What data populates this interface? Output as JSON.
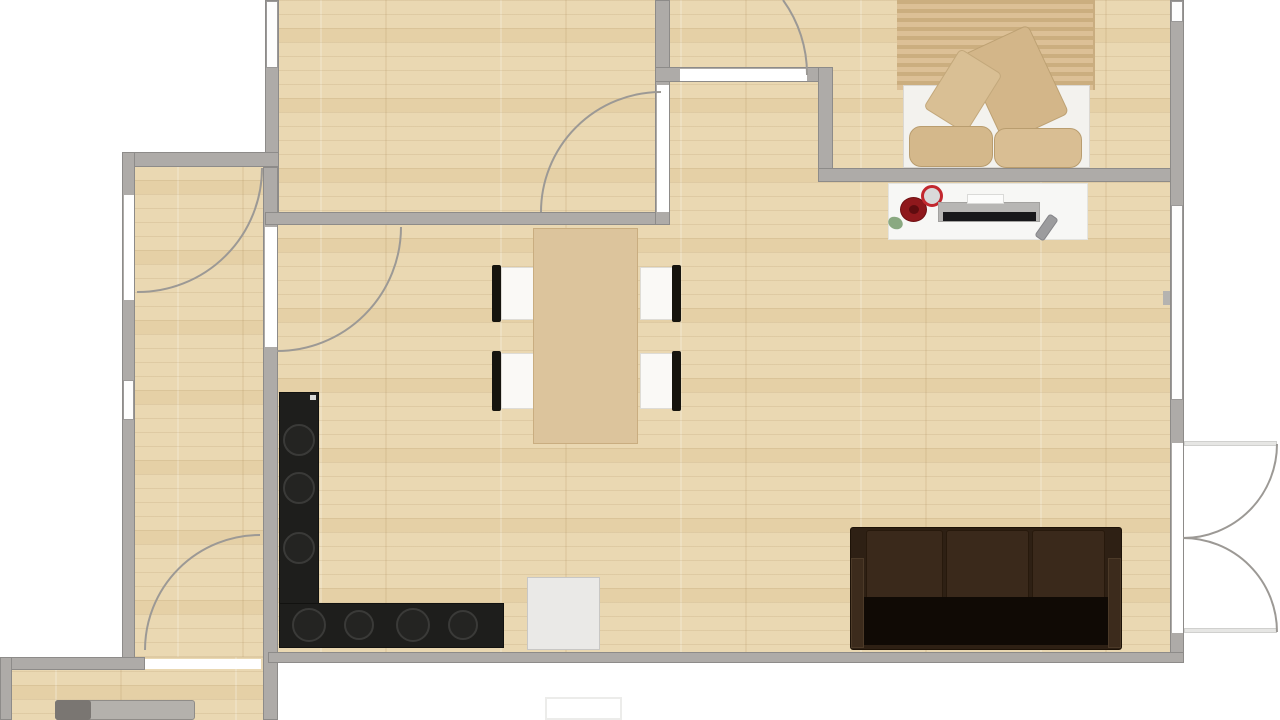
{
  "document": {
    "kind": "apartment-floor-plan",
    "visible_text": ""
  },
  "palette": {
    "background": "#ffffff",
    "wall": "#aeaba8",
    "wall_edge": "#8d8b89",
    "floor_wood": "#ead8b2",
    "opening": "#ffffff",
    "counter_black": "#1e1e1c",
    "sofa_brown": "#2e2014",
    "accent_red": "#c2272e"
  },
  "floors": [
    {
      "n": "floor-main-rooms",
      "cls": "wood",
      "x": 265,
      "y": 0,
      "w": 919,
      "h": 663,
      "z": 1
    },
    {
      "n": "floor-hallway",
      "cls": "wood",
      "x": 122,
      "y": 152,
      "w": 155,
      "h": 511,
      "z": 1
    },
    {
      "n": "floor-bottom-room",
      "cls": "wood",
      "x": 0,
      "y": 657,
      "w": 278,
      "h": 63,
      "z": 1
    },
    {
      "n": "bedroom-rug",
      "cls": "rug",
      "x": 897,
      "y": 0,
      "w": 198,
      "h": 90,
      "z": 2
    }
  ],
  "walls": [
    {
      "n": "wall-room2-left",
      "x": 265,
      "y": 0,
      "w": 14,
      "h": 225
    },
    {
      "n": "wall-hall-top",
      "x": 122,
      "y": 152,
      "w": 157,
      "h": 15
    },
    {
      "n": "wall-hall-left",
      "x": 122,
      "y": 152,
      "w": 13,
      "h": 511
    },
    {
      "n": "wall-divider-vert",
      "x": 263,
      "y": 167,
      "w": 15,
      "h": 553
    },
    {
      "n": "wall-room2-bottom",
      "x": 265,
      "y": 212,
      "w": 405,
      "h": 13
    },
    {
      "n": "wall-room2-right",
      "x": 655,
      "y": 0,
      "w": 15,
      "h": 225
    },
    {
      "n": "wall-bedroom-top",
      "x": 655,
      "y": 67,
      "w": 178,
      "h": 15
    },
    {
      "n": "wall-bedroom-west",
      "x": 818,
      "y": 67,
      "w": 15,
      "h": 115
    },
    {
      "n": "wall-bedroom-bottom",
      "x": 818,
      "y": 168,
      "w": 366,
      "h": 14
    },
    {
      "n": "wall-right",
      "x": 1170,
      "y": 0,
      "w": 14,
      "h": 662
    },
    {
      "n": "wall-bottom-main",
      "x": 268,
      "y": 652,
      "w": 916,
      "h": 11
    },
    {
      "n": "wall-room3-top",
      "x": 0,
      "y": 657,
      "w": 145,
      "h": 13
    },
    {
      "n": "wall-room3-left",
      "x": 0,
      "y": 657,
      "w": 12,
      "h": 63
    }
  ],
  "windows": [
    {
      "n": "window-room2-left",
      "x": 266,
      "y": 1,
      "w": 12,
      "h": 67
    },
    {
      "n": "window-hall-left",
      "x": 123,
      "y": 380,
      "w": 11,
      "h": 40
    },
    {
      "n": "window-right-top",
      "x": 1171,
      "y": 1,
      "w": 12,
      "h": 21
    },
    {
      "n": "window-right-mid",
      "x": 1171,
      "y": 205,
      "w": 12,
      "h": 195
    }
  ],
  "openings": [
    {
      "n": "opening-entry-door",
      "x": 124,
      "y": 195,
      "w": 10,
      "h": 105
    },
    {
      "n": "opening-hall-living",
      "x": 265,
      "y": 227,
      "w": 12,
      "h": 120
    },
    {
      "n": "opening-room2-door",
      "x": 657,
      "y": 85,
      "w": 12,
      "h": 127
    },
    {
      "n": "opening-bedroom-door",
      "x": 680,
      "y": 69,
      "w": 127,
      "h": 12
    },
    {
      "n": "opening-hall-bottom",
      "x": 145,
      "y": 659,
      "w": 116,
      "h": 10
    },
    {
      "n": "opening-balcony-doors",
      "x": 1172,
      "y": 443,
      "w": 11,
      "h": 190
    }
  ],
  "door_arcs": [
    {
      "n": "arc-room2-door",
      "d": "M 661 92 A 120 120 0 0 0 541 212"
    },
    {
      "n": "arc-entry-door",
      "d": "M 262 168 A 124 124 0 0 1 137 292"
    },
    {
      "n": "arc-hall-living",
      "d": "M 401 227 A 124 124 0 0 1 277 351"
    },
    {
      "n": "arc-hall-bottom",
      "d": "M 145 650 A 115 115 0 0 1 260 535"
    },
    {
      "n": "arc-bedroom-door",
      "d": "M 807 75 A 126 126 0 0 0 783 0"
    },
    {
      "n": "arc-balcony-upper",
      "d": "M 1183 538 A 94 94 0 0 0 1277 444"
    },
    {
      "n": "arc-balcony-lower",
      "d": "M 1183 538 A 94 94 0 0 1 1277 632"
    }
  ],
  "arc_style": {
    "stroke": "#9c9995",
    "width": 2
  },
  "furniture": [
    {
      "n": "balcony-door-leaf-top",
      "x": 1184,
      "y": 441,
      "w": 93,
      "h": 5,
      "f": "#e6e6e4",
      "b": "#d0d0ce",
      "z": 4
    },
    {
      "n": "balcony-door-leaf-bottom",
      "x": 1184,
      "y": 628,
      "w": 93,
      "h": 5,
      "f": "#e6e6e4",
      "b": "#d0d0ce",
      "z": 4
    },
    {
      "n": "window-handle-tick",
      "x": 1163,
      "y": 291,
      "w": 7,
      "h": 14,
      "f": "#b5b3b0",
      "z": 4
    },
    {
      "n": "bed-mattress",
      "x": 903,
      "y": 85,
      "w": 187,
      "h": 83,
      "f": "#f3f2ee",
      "b": "#dbd8d2",
      "z": 6
    },
    {
      "n": "bed-pillow-large",
      "x": 980,
      "y": 35,
      "w": 72,
      "h": 98,
      "f": "#d3b689",
      "b": "#bda173",
      "r": "6px",
      "rot": -25,
      "z": 7
    },
    {
      "n": "bed-pillow-small",
      "x": 938,
      "y": 56,
      "w": 50,
      "h": 70,
      "f": "#d9bf94",
      "b": "#c3a87b",
      "r": "5px",
      "rot": 32,
      "z": 8
    },
    {
      "n": "bed-cushion-left",
      "x": 909,
      "y": 126,
      "w": 84,
      "h": 41,
      "f": "#d4b88b",
      "b": "#b99d6f",
      "r": "12px",
      "z": 9
    },
    {
      "n": "bed-cushion-right",
      "x": 994,
      "y": 128,
      "w": 88,
      "h": 40,
      "f": "#d9be93",
      "b": "#b99d6f",
      "r": "12px",
      "z": 9
    },
    {
      "n": "desk",
      "x": 888,
      "y": 183,
      "w": 200,
      "h": 57,
      "f": "#f7f7f5",
      "b": "#e4e4e0",
      "z": 6
    },
    {
      "n": "desk-rose",
      "x": 900,
      "y": 197,
      "w": 27,
      "h": 25,
      "f": "#8f181c",
      "b": "#701013",
      "r": "50%",
      "z": 7
    },
    {
      "n": "desk-rose-center",
      "x": 909,
      "y": 205,
      "w": 10,
      "h": 9,
      "f": "#5f0c0f",
      "r": "50%",
      "z": 8
    },
    {
      "n": "desk-leaf",
      "x": 888,
      "y": 217,
      "w": 15,
      "h": 12,
      "f": "#8aa981",
      "r": "60%",
      "rot": 25,
      "z": 7
    },
    {
      "n": "desk-clock",
      "x": 921,
      "y": 185,
      "w": 22,
      "h": 22,
      "f": "#d9d9d9",
      "b": "#c2272e",
      "bw": 3,
      "r": "50%",
      "z": 7
    },
    {
      "n": "desk-tv-body",
      "x": 938,
      "y": 202,
      "w": 102,
      "h": 20,
      "f": "#b7b6b4",
      "b": "#a3a2a0",
      "z": 7
    },
    {
      "n": "desk-tv-screen",
      "x": 943,
      "y": 212,
      "w": 93,
      "h": 9,
      "f": "#18181b",
      "z": 8
    },
    {
      "n": "desk-tv-label",
      "x": 967,
      "y": 194,
      "w": 37,
      "h": 10,
      "f": "#fcfcfb",
      "b": "#dadad8",
      "z": 8
    },
    {
      "n": "desk-remote",
      "x": 1041,
      "y": 214,
      "w": 11,
      "h": 27,
      "f": "#9c9c9e",
      "b": "#858589",
      "r": "3px",
      "rot": 35,
      "z": 7
    },
    {
      "n": "dining-table",
      "x": 533,
      "y": 228,
      "w": 105,
      "h": 216,
      "f": "#dcc49c",
      "b": "#c9ad80",
      "z": 7
    },
    {
      "n": "chair-seat-tl",
      "x": 501,
      "y": 267,
      "w": 34,
      "h": 53,
      "f": "#faf9f6",
      "b": "#dedcd6",
      "z": 6
    },
    {
      "n": "chair-back-tl",
      "x": 492,
      "y": 265,
      "w": 9,
      "h": 57,
      "f": "#16140e",
      "r": "2px",
      "z": 6
    },
    {
      "n": "chair-seat-bl",
      "x": 501,
      "y": 353,
      "w": 34,
      "h": 56,
      "f": "#faf9f6",
      "b": "#dedcd6",
      "z": 6
    },
    {
      "n": "chair-back-bl",
      "x": 492,
      "y": 351,
      "w": 9,
      "h": 60,
      "f": "#16140e",
      "r": "2px",
      "z": 6
    },
    {
      "n": "chair-seat-tr",
      "x": 640,
      "y": 267,
      "w": 34,
      "h": 53,
      "f": "#faf9f6",
      "b": "#dedcd6",
      "z": 6
    },
    {
      "n": "chair-back-tr",
      "x": 672,
      "y": 265,
      "w": 9,
      "h": 57,
      "f": "#16140e",
      "r": "2px",
      "z": 6
    },
    {
      "n": "chair-seat-br",
      "x": 640,
      "y": 353,
      "w": 34,
      "h": 56,
      "f": "#faf9f6",
      "b": "#dedcd6",
      "z": 6
    },
    {
      "n": "chair-back-br",
      "x": 672,
      "y": 351,
      "w": 9,
      "h": 60,
      "f": "#16140e",
      "r": "2px",
      "z": 6
    },
    {
      "n": "kitchen-counter-vertical",
      "x": 279,
      "y": 392,
      "w": 40,
      "h": 216,
      "f": "#1e1e1c",
      "b": "#121210",
      "z": 6
    },
    {
      "n": "kitchen-counter-horizontal",
      "x": 279,
      "y": 603,
      "w": 225,
      "h": 45,
      "f": "#1e1e1c",
      "b": "#121210",
      "z": 6
    },
    {
      "n": "kitchen-burner-1",
      "x": 283,
      "y": 424,
      "w": 32,
      "h": 32,
      "f": "#242422",
      "b": "#3a3a38",
      "bw": 2,
      "r": "50%",
      "z": 7
    },
    {
      "n": "kitchen-burner-2",
      "x": 283,
      "y": 472,
      "w": 32,
      "h": 32,
      "f": "#242422",
      "b": "#3a3a38",
      "bw": 2,
      "r": "50%",
      "z": 7
    },
    {
      "n": "kitchen-burner-3",
      "x": 283,
      "y": 532,
      "w": 32,
      "h": 32,
      "f": "#242422",
      "b": "#3a3a38",
      "bw": 2,
      "r": "50%",
      "z": 7
    },
    {
      "n": "kitchen-burner-4",
      "x": 292,
      "y": 608,
      "w": 34,
      "h": 34,
      "f": "#242422",
      "b": "#3a3a38",
      "bw": 2,
      "r": "50%",
      "z": 7
    },
    {
      "n": "kitchen-burner-5",
      "x": 344,
      "y": 610,
      "w": 30,
      "h": 30,
      "f": "#242422",
      "b": "#3a3a38",
      "bw": 2,
      "r": "50%",
      "z": 7
    },
    {
      "n": "kitchen-burner-6",
      "x": 396,
      "y": 608,
      "w": 34,
      "h": 34,
      "f": "#242422",
      "b": "#3a3a38",
      "bw": 2,
      "r": "50%",
      "z": 7
    },
    {
      "n": "kitchen-burner-7",
      "x": 448,
      "y": 610,
      "w": 30,
      "h": 30,
      "f": "#242422",
      "b": "#3a3a38",
      "bw": 2,
      "r": "50%",
      "z": 7
    },
    {
      "n": "kitchen-counter-chip",
      "x": 310,
      "y": 395,
      "w": 6,
      "h": 5,
      "f": "#d8d8d6",
      "z": 8
    },
    {
      "n": "kitchen-appliance",
      "x": 527,
      "y": 577,
      "w": 73,
      "h": 73,
      "f": "#eae9e7",
      "b": "#c8c7c5",
      "z": 6
    },
    {
      "n": "sofa-body",
      "x": 850,
      "y": 527,
      "w": 272,
      "h": 123,
      "f": "#2e2014",
      "b": "#1d1207",
      "r": "3px",
      "z": 6
    },
    {
      "n": "sofa-cushion-1",
      "x": 866,
      "y": 530,
      "w": 77,
      "h": 70,
      "f": "#3a291b",
      "b": "#27190c",
      "r": "3px",
      "z": 7
    },
    {
      "n": "sofa-cushion-2",
      "x": 946,
      "y": 530,
      "w": 83,
      "h": 70,
      "f": "#3a291b",
      "b": "#27190c",
      "r": "3px",
      "z": 7
    },
    {
      "n": "sofa-cushion-3",
      "x": 1032,
      "y": 530,
      "w": 73,
      "h": 70,
      "f": "#3a291b",
      "b": "#27190c",
      "r": "3px",
      "z": 7
    },
    {
      "n": "sofa-seat-shadow",
      "x": 858,
      "y": 597,
      "w": 256,
      "h": 48,
      "f": "#100a05",
      "r": "2px",
      "z": 8
    },
    {
      "n": "sofa-armrest-left",
      "x": 851,
      "y": 558,
      "w": 13,
      "h": 90,
      "f": "#3c2b1c",
      "b": "#4c3a28",
      "z": 9
    },
    {
      "n": "sofa-armrest-right",
      "x": 1108,
      "y": 558,
      "w": 13,
      "h": 90,
      "f": "#3c2b1c",
      "b": "#4c3a28",
      "z": 9
    },
    {
      "n": "bottom-room-furniture",
      "x": 55,
      "y": 700,
      "w": 140,
      "h": 20,
      "f": "#b4b1ac",
      "b": "#8f8c88",
      "r": "3px",
      "z": 6
    },
    {
      "n": "bottom-room-furniture-dark",
      "x": 55,
      "y": 700,
      "w": 36,
      "h": 20,
      "f": "#7a7672",
      "r": "3px",
      "z": 7
    },
    {
      "n": "outside-doormat",
      "x": 545,
      "y": 697,
      "w": 77,
      "h": 23,
      "f": "#ffffff",
      "b": "#ececea",
      "bw": 2,
      "z": 2
    }
  ]
}
